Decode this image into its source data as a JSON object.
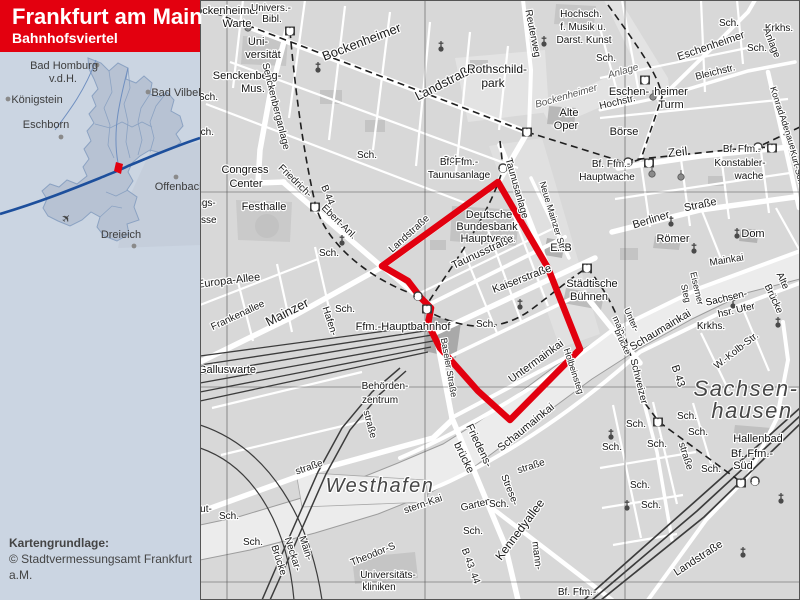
{
  "header": {
    "title": "Frankfurt am Main",
    "subtitle": "Bahnhofsviertel",
    "bg_color": "#e3000f",
    "text_color": "#ffffff"
  },
  "attribution": {
    "line1": "Kartengrundlage:",
    "line2": "© Stadtvermessungsamt Frankfurt a.M."
  },
  "inset": {
    "marker_color": "#e3000f",
    "airplane": {
      "glyph": "✈",
      "x": 69,
      "y": 221
    },
    "towns": [
      {
        "name": "Bad Homburg",
        "line2": "v.d.H.",
        "tx": 64,
        "ty": 69,
        "tx2": 63,
        "ty2": 82,
        "dotx": 97,
        "doty": 65
      },
      {
        "name": "Königstein",
        "tx": 37,
        "ty": 103,
        "dotx": 8,
        "doty": 99
      },
      {
        "name": "Eschborn",
        "tx": 46,
        "ty": 128,
        "dotx": 61,
        "doty": 137
      },
      {
        "name": "Bad Vilbel",
        "tx": 176,
        "ty": 96,
        "dotx": 148,
        "doty": 92
      },
      {
        "name": "Offenbach",
        "tx": 180,
        "ty": 190,
        "dotx": 176,
        "doty": 177
      },
      {
        "name": "Dreieich",
        "tx": 121,
        "ty": 238,
        "dotx": 134,
        "doty": 246
      }
    ]
  },
  "map": {
    "boundary_color": "#e2000f",
    "boundary_points": "498,182 548,268 580,349 510,420 478,391 440,348 428,324 431,308 421,298 408,281 382,266",
    "labels": [
      [
        "Bockenheimer",
        224,
        14,
        0,
        11,
        "p"
      ],
      [
        "Warte",
        237,
        27,
        0,
        11,
        "p"
      ],
      [
        "Univers.-",
        271,
        11,
        0,
        10,
        "p"
      ],
      [
        "Bibl.",
        272,
        22,
        0,
        10,
        "p"
      ],
      [
        "Uni-",
        258,
        45,
        0,
        11,
        "p"
      ],
      [
        "versität",
        263,
        58,
        0,
        11,
        "p"
      ],
      [
        "Senckenberg-",
        247,
        79,
        0,
        11,
        "p"
      ],
      [
        "Mus.",
        253,
        92,
        0,
        11,
        "p"
      ],
      [
        "Senckenberganlage",
        273,
        107,
        76,
        10,
        "s"
      ],
      [
        "Bockenheimer",
        363,
        46,
        -21,
        13,
        "s"
      ],
      [
        "Landstraße",
        447,
        86,
        -27,
        13,
        "s"
      ],
      [
        "Reuterweg",
        530,
        34,
        79,
        10,
        "s"
      ],
      [
        "Rothschild-",
        497,
        73,
        0,
        12,
        "p"
      ],
      [
        "park",
        493,
        87,
        0,
        12,
        "p"
      ],
      [
        "Hochsch.",
        581,
        17,
        0,
        10,
        "p"
      ],
      [
        "f. Musik u.",
        583,
        30,
        0,
        10,
        "p"
      ],
      [
        "Darst. Kunst",
        584,
        43,
        0,
        10,
        "p"
      ],
      [
        "Sch.",
        208,
        100,
        0,
        10,
        "p"
      ],
      [
        "Sch.",
        204,
        135,
        0,
        10,
        "p"
      ],
      [
        "Sch.",
        367,
        158,
        0,
        10,
        "p"
      ],
      [
        "Sch.",
        453,
        163,
        0,
        10,
        "p"
      ],
      [
        "Congress",
        245,
        173,
        0,
        11,
        "p"
      ],
      [
        "Center",
        246,
        187,
        0,
        11,
        "p"
      ],
      [
        "Friedrich-",
        293,
        183,
        44,
        10,
        "s"
      ],
      [
        "Ebert-Anl.",
        337,
        224,
        44,
        10,
        "s"
      ],
      [
        "B 44",
        325,
        196,
        68,
        10,
        "s"
      ],
      [
        "ngs-",
        206,
        206,
        0,
        10,
        "p"
      ],
      [
        "esse",
        206,
        223,
        0,
        10,
        "p"
      ],
      [
        "Festhalle",
        264,
        210,
        0,
        11,
        "p"
      ],
      [
        "Bf. Ffm.-",
        459,
        165,
        0,
        10,
        "p"
      ],
      [
        "Taunusanlage",
        459,
        178,
        0,
        10,
        "p"
      ],
      [
        "Taunusanlage",
        514,
        189,
        74,
        10,
        "s"
      ],
      [
        "Alte",
        569,
        116,
        0,
        11,
        "p"
      ],
      [
        "Oper",
        566,
        129,
        0,
        11,
        "p"
      ],
      [
        "Bockenheimer",
        567,
        99,
        -16,
        10,
        "g"
      ],
      [
        "Anlage",
        624,
        74,
        -16,
        10,
        "g"
      ],
      [
        "Eschenheimer",
        712,
        49,
        -19,
        11,
        "s"
      ],
      [
        "Sch.",
        729,
        26,
        0,
        10,
        "p"
      ],
      [
        "Sch.",
        757,
        51,
        0,
        10,
        "p"
      ],
      [
        "Sch.",
        606,
        61,
        0,
        10,
        "p"
      ],
      [
        "Krkhs.",
        779,
        31,
        0,
        10,
        "p"
      ],
      [
        "Anlage",
        769,
        44,
        68,
        10,
        "s"
      ],
      [
        "Bleichstr.",
        716,
        75,
        -14,
        10,
        "s"
      ],
      [
        "Eschen-",
        629,
        95,
        0,
        11,
        "p"
      ],
      [
        "heimer",
        671,
        95,
        0,
        11,
        "p"
      ],
      [
        "Turm",
        671,
        108,
        0,
        11,
        "p"
      ],
      [
        "Hochstr.",
        618,
        105,
        -13,
        10,
        "s"
      ],
      [
        "Börse",
        624,
        135,
        0,
        11,
        "p"
      ],
      [
        "Zeil",
        678,
        156,
        -6,
        12,
        "s"
      ],
      [
        "Bf. Ffm.-",
        742,
        152,
        0,
        10,
        "p"
      ],
      [
        "Konstabler-",
        740,
        166,
        0,
        10,
        "p"
      ],
      [
        "wache",
        749,
        179,
        0,
        10,
        "p"
      ],
      [
        "Bf. Ffm.-",
        611,
        167,
        0,
        10,
        "p"
      ],
      [
        "Hauptwache",
        607,
        180,
        0,
        10,
        "p"
      ],
      [
        "Konrad-",
        775,
        103,
        72,
        9,
        "s"
      ],
      [
        "Adenauer-",
        786,
        136,
        72,
        9,
        "s"
      ],
      [
        "Kurt-Schu",
        795,
        170,
        75,
        9,
        "s"
      ],
      [
        "Deutsche",
        489,
        218,
        0,
        11,
        "p"
      ],
      [
        "Bundesbank",
        487,
        230,
        0,
        11,
        "p"
      ],
      [
        "Hauptverw.",
        488,
        242,
        0,
        11,
        "p"
      ],
      [
        "Taunusstraße",
        484,
        255,
        -25,
        11,
        "s"
      ],
      [
        "Kaiserstraße",
        523,
        282,
        -21,
        11,
        "s"
      ],
      [
        "EZB",
        561,
        251,
        0,
        11,
        "p"
      ],
      [
        "Neue Mainzer Str.",
        550,
        217,
        73,
        9,
        "s"
      ],
      [
        "Landstraße",
        411,
        236,
        -42,
        10,
        "s"
      ],
      [
        "Städtische",
        592,
        287,
        0,
        11,
        "p"
      ],
      [
        "Bühnen",
        589,
        300,
        0,
        11,
        "p"
      ],
      [
        "Sch.",
        486,
        327,
        0,
        10,
        "p"
      ],
      [
        "Untermainkai",
        538,
        364,
        -36,
        11,
        "s"
      ],
      [
        "Holbeinsteg",
        571,
        372,
        72,
        9,
        "s"
      ],
      [
        "Ffm.-Hauptbahnhof",
        403,
        330,
        0,
        11,
        "p"
      ],
      [
        "Baseler Straße",
        446,
        368,
        80,
        9,
        "s"
      ],
      [
        "Behörden-",
        385,
        389,
        0,
        10,
        "p"
      ],
      [
        "zentrum",
        380,
        403,
        0,
        10,
        "p"
      ],
      [
        "Galluswarte",
        227,
        373,
        0,
        11,
        "p"
      ],
      [
        "Mainzer",
        289,
        316,
        -27,
        13,
        "s"
      ],
      [
        "Frankenallee",
        239,
        318,
        -25,
        10,
        "s"
      ],
      [
        "Europa-Allee",
        229,
        284,
        -7,
        11,
        "s"
      ],
      [
        "Hafen-",
        327,
        322,
        72,
        10,
        "s"
      ],
      [
        "Sch.",
        345,
        312,
        0,
        10,
        "p"
      ],
      [
        "Sch.",
        329,
        256,
        0,
        10,
        "p"
      ],
      [
        "straße",
        310,
        470,
        -19,
        10,
        "s"
      ],
      [
        "ut-",
        206,
        512,
        0,
        10,
        "s"
      ],
      [
        "straße",
        367,
        425,
        75,
        10,
        "s"
      ],
      [
        "Sch.",
        229,
        519,
        0,
        10,
        "p"
      ],
      [
        "Sch.",
        253,
        545,
        0,
        10,
        "p"
      ],
      [
        "Westhafen",
        380,
        492,
        0,
        20,
        "a"
      ],
      [
        "Main-",
        303,
        549,
        72,
        10,
        "s"
      ],
      [
        "Neckar-",
        290,
        555,
        72,
        10,
        "s"
      ],
      [
        "Brücke",
        276,
        561,
        72,
        10,
        "s"
      ],
      [
        "Theodor-S",
        374,
        557,
        -22,
        10,
        "s"
      ],
      [
        "stern-Kai",
        424,
        507,
        -19,
        10,
        "s"
      ],
      [
        "Universitäts-",
        388,
        578,
        0,
        10,
        "p"
      ],
      [
        "kliniken",
        379,
        590,
        0,
        10,
        "p"
      ],
      [
        "Friedens-",
        476,
        447,
        64,
        11,
        "s"
      ],
      [
        "brücke",
        461,
        459,
        64,
        11,
        "s"
      ],
      [
        "Schaumainkai",
        528,
        430,
        -39,
        11,
        "s"
      ],
      [
        "straße",
        532,
        469,
        -18,
        10,
        "s"
      ],
      [
        "Garten-",
        478,
        507,
        -13,
        10,
        "s"
      ],
      [
        "Strese-",
        507,
        491,
        68,
        10,
        "s"
      ],
      [
        "mann-",
        534,
        556,
        83,
        10,
        "s"
      ],
      [
        "Kennedyallee",
        523,
        532,
        -53,
        12,
        "s"
      ],
      [
        "Sch.",
        499,
        507,
        0,
        10,
        "p"
      ],
      [
        "Sch.",
        473,
        534,
        0,
        10,
        "p"
      ],
      [
        "B 43, 44",
        468,
        567,
        70,
        10,
        "s"
      ],
      [
        "Bf. Ffm.-",
        577,
        595,
        0,
        10,
        "p"
      ],
      [
        "Berliner",
        652,
        223,
        -17,
        11,
        "s"
      ],
      [
        "Straße",
        701,
        208,
        -12,
        11,
        "s"
      ],
      [
        "Römer",
        673,
        242,
        0,
        11,
        "p"
      ],
      [
        "Dom",
        753,
        237,
        0,
        11,
        "p"
      ],
      [
        "Mainkai",
        727,
        263,
        -9,
        10,
        "s"
      ],
      [
        "Eiserner",
        694,
        289,
        77,
        9,
        "s"
      ],
      [
        "Steg",
        683,
        294,
        77,
        9,
        "s"
      ],
      [
        "Alte",
        780,
        282,
        65,
        10,
        "s"
      ],
      [
        "Brücke",
        771,
        300,
        65,
        10,
        "s"
      ],
      [
        "Sachsen-",
        727,
        301,
        -13,
        10,
        "p"
      ],
      [
        "hsr. Ufer",
        737,
        313,
        -13,
        10,
        "p"
      ],
      [
        "Schaumainkai",
        662,
        333,
        -31,
        11,
        "s"
      ],
      [
        "Unter-",
        629,
        321,
        65,
        9,
        "s"
      ],
      [
        "main-",
        617,
        328,
        65,
        9,
        "s"
      ],
      [
        "brücke",
        620,
        343,
        65,
        9,
        "s"
      ],
      [
        "Schweizer",
        636,
        382,
        76,
        10,
        "s"
      ],
      [
        "Krkhs.",
        711,
        329,
        0,
        10,
        "p"
      ],
      [
        "W.-Kolb-Str.",
        738,
        353,
        -38,
        10,
        "s"
      ],
      [
        "B 43",
        675,
        377,
        72,
        11,
        "s"
      ],
      [
        "Sachsen-",
        746,
        396,
        0,
        22,
        "a"
      ],
      [
        "hausen",
        752,
        418,
        0,
        22,
        "a"
      ],
      [
        "Hallenbad",
        758,
        442,
        0,
        11,
        "p"
      ],
      [
        "Bf. Ffm.-",
        752,
        457,
        0,
        11,
        "p"
      ],
      [
        "Süd",
        743,
        469,
        0,
        11,
        "p"
      ],
      [
        "Sch.",
        687,
        419,
        0,
        10,
        "p"
      ],
      [
        "Sch.",
        636,
        427,
        0,
        10,
        "p"
      ],
      [
        "Sch.",
        612,
        450,
        0,
        10,
        "p"
      ],
      [
        "Sch.",
        657,
        447,
        0,
        10,
        "p"
      ],
      [
        "Sch.",
        698,
        435,
        0,
        10,
        "p"
      ],
      [
        "Sch.",
        711,
        472,
        0,
        10,
        "p"
      ],
      [
        "Sch.",
        640,
        488,
        0,
        10,
        "p"
      ],
      [
        "Sch.",
        651,
        508,
        0,
        10,
        "p"
      ],
      [
        "straße",
        683,
        457,
        72,
        10,
        "s"
      ],
      [
        "Landstraße",
        700,
        561,
        -33,
        11,
        "s"
      ]
    ],
    "icons": [
      [
        "u",
        290,
        31
      ],
      [
        "u",
        315,
        207
      ],
      [
        "u",
        527,
        132
      ],
      [
        "u",
        645,
        80
      ],
      [
        "u",
        427,
        309
      ],
      [
        "u",
        587,
        268
      ],
      [
        "u",
        649,
        163
      ],
      [
        "u",
        772,
        148
      ],
      [
        "u",
        658,
        422
      ],
      [
        "u",
        741,
        483
      ],
      [
        "s",
        503,
        168
      ],
      [
        "s",
        418,
        296
      ],
      [
        "s",
        628,
        162
      ],
      [
        "s",
        758,
        147
      ],
      [
        "s",
        755,
        481
      ],
      [
        "c",
        318,
        70
      ],
      [
        "c",
        441,
        49
      ],
      [
        "c",
        544,
        44
      ],
      [
        "c",
        671,
        224
      ],
      [
        "c",
        694,
        251
      ],
      [
        "c",
        737,
        236
      ],
      [
        "c",
        520,
        307
      ],
      [
        "c",
        342,
        243
      ],
      [
        "c",
        733,
        306
      ],
      [
        "c",
        778,
        325
      ],
      [
        "c",
        611,
        437
      ],
      [
        "c",
        627,
        508
      ],
      [
        "c",
        743,
        555
      ],
      [
        "c",
        781,
        501
      ],
      [
        "t",
        248,
        28
      ],
      [
        "t",
        653,
        97
      ],
      [
        "t",
        652,
        174
      ],
      [
        "t",
        681,
        177
      ]
    ]
  }
}
